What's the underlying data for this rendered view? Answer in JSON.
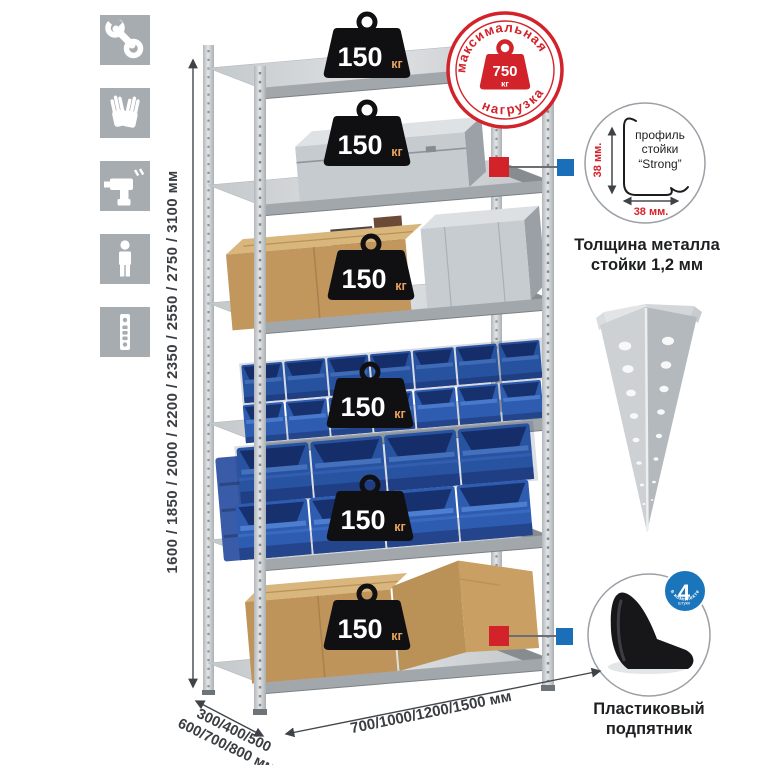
{
  "left_icons": [
    {
      "name": "wrench-icon"
    },
    {
      "name": "gloves-icon"
    },
    {
      "name": "drill-icon"
    },
    {
      "name": "person-icon"
    },
    {
      "name": "perforated-post-icon"
    }
  ],
  "dimensions": {
    "height_label": "1600 / 1850 / 2000 / 2200 / 2350 / 2550 / 2750 / 3100 мм",
    "depth_label_line1": "300/400/500",
    "depth_label_line2": "600/700/800 мм",
    "width_label": "700/1000/1200/1500 мм"
  },
  "shelf_loads": {
    "unit": "кг",
    "values": [
      "150",
      "150",
      "150",
      "150",
      "150",
      "150"
    ]
  },
  "max_load_stamp": {
    "arc_top": "максимальная",
    "arc_bottom": "нагрузка",
    "value": "750",
    "unit": "кг"
  },
  "profile_callout": {
    "line1": "профиль",
    "line2": "стойки",
    "line3": "“Strong”",
    "dim_vertical": "38 мм.",
    "dim_horizontal": "38 мм.",
    "caption_line1": "Толщина металла",
    "caption_line2": "стойки 1,2 мм"
  },
  "foot_callout": {
    "badge_value": "4",
    "badge_small": "штуки",
    "badge_arc": "в комплекте",
    "caption_line1": "Пластиковый",
    "caption_line2": "подпятник"
  },
  "colors": {
    "accent_red": "#d2232a",
    "accent_blue": "#1b6fb8",
    "icon_gray": "#a7acb1",
    "bin_blue": "#2d5cb0",
    "cardboard": "#c0955b",
    "steel": "#c7cbce"
  }
}
